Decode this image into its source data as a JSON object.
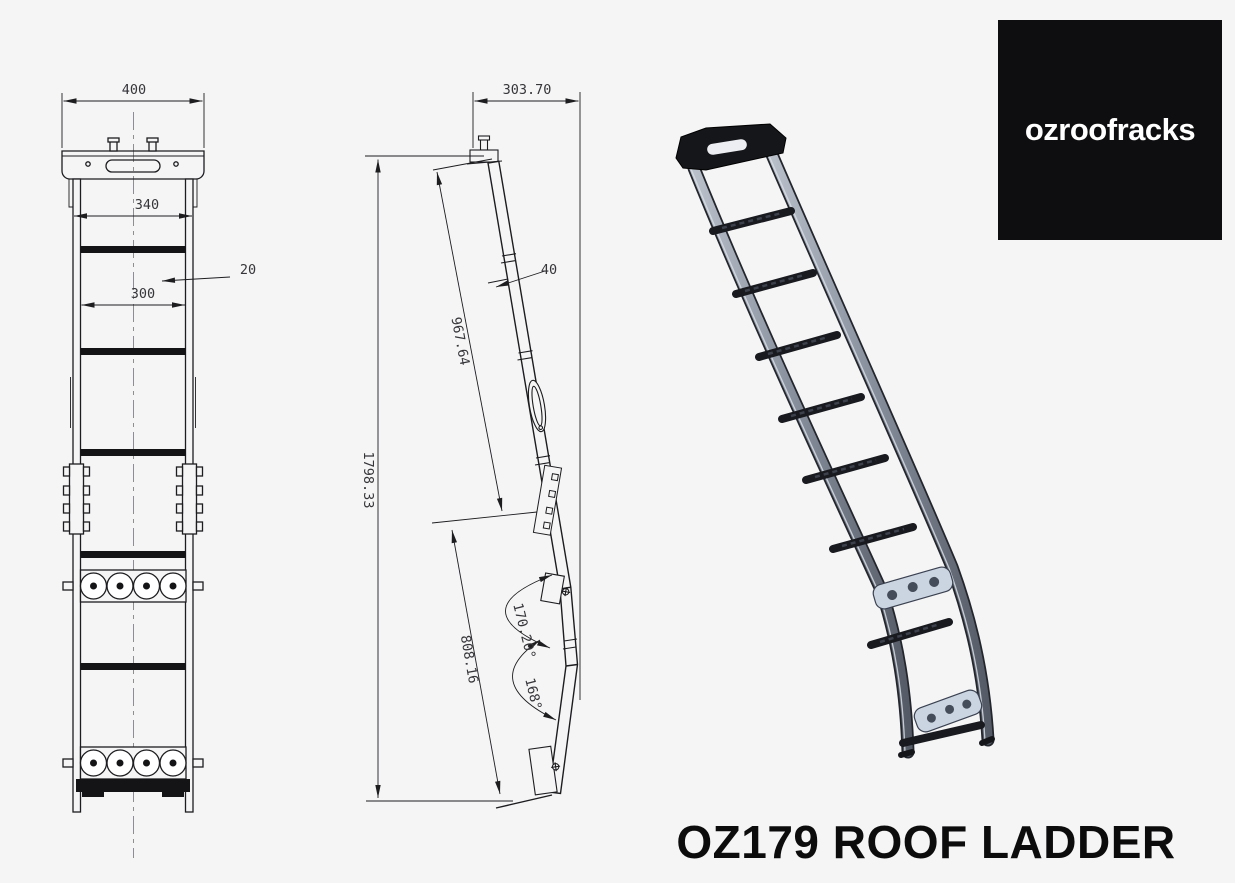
{
  "page": {
    "background": "#f5f5f6",
    "line_color": "#1d1d20"
  },
  "brand": {
    "logo_text": "ozroofracks",
    "logo_bg": "#0e0e10",
    "logo_fg": "#ffffff"
  },
  "title": {
    "text": "OZ179 ROOF LADDER"
  },
  "front_view": {
    "dimensions": {
      "top_width": "400",
      "outer_width": "340",
      "tube_width": "20",
      "inner_width": "300"
    }
  },
  "side_view": {
    "dimensions": {
      "top_offset": "303.70",
      "tube_depth": "40",
      "upper_length": "967.64",
      "overall_height": "1798.33",
      "lower_length": "808.16",
      "upper_angle": "170.20°",
      "lower_angle": "168°"
    }
  },
  "render_colors": {
    "rail_mid": "#848c9a",
    "rail_dark": "#23262c",
    "rung": "#181a1f",
    "plate": "#cbd4e1",
    "top_mount": "#15161a"
  }
}
